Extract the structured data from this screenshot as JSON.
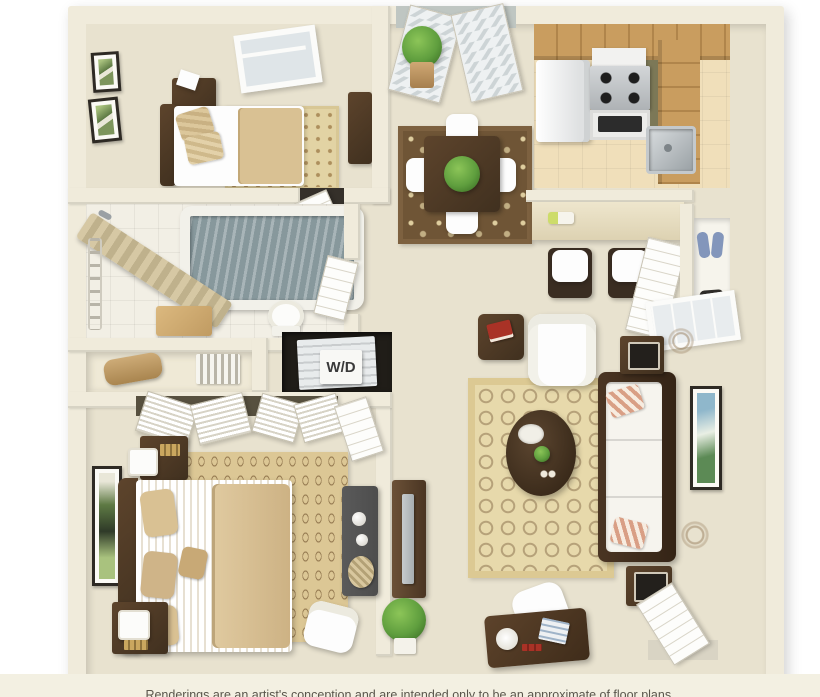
{
  "labels": {
    "washer_dryer": "W/D"
  },
  "disclaimer": "Renderings are an artist's conception and are intended only to be an approximate of floor plans.",
  "colors": {
    "background": "#ffffff",
    "wall": "#f0ebdb",
    "wall_shade": "#d8d1ba",
    "carpet": "#e8e2cf",
    "kitchen_tile": "#f0dfba",
    "bath_tile": "#f2efe5",
    "wood_dark": "#40301f",
    "wood_mid": "#5d442c",
    "cabinet_wood": "#c99d5f",
    "counter_olive": "#7c7857",
    "white_furnishing": "#fdfdfd",
    "bedding_tan": "#d9c193",
    "rug_tan": "#e2d3a4",
    "rug_brown": "#6f5536",
    "water": "#87989c",
    "plant_green": "#5f9e3e",
    "book_red": "#a93226",
    "tv_gray": "#a7adb0",
    "dresser_gray": "#4d4d4d",
    "appliance_white": "#f4f4f4",
    "shoe_blue": "#8396bb",
    "pillow_stripe": "#d99f85",
    "label_text": "#3a3a3a"
  }
}
